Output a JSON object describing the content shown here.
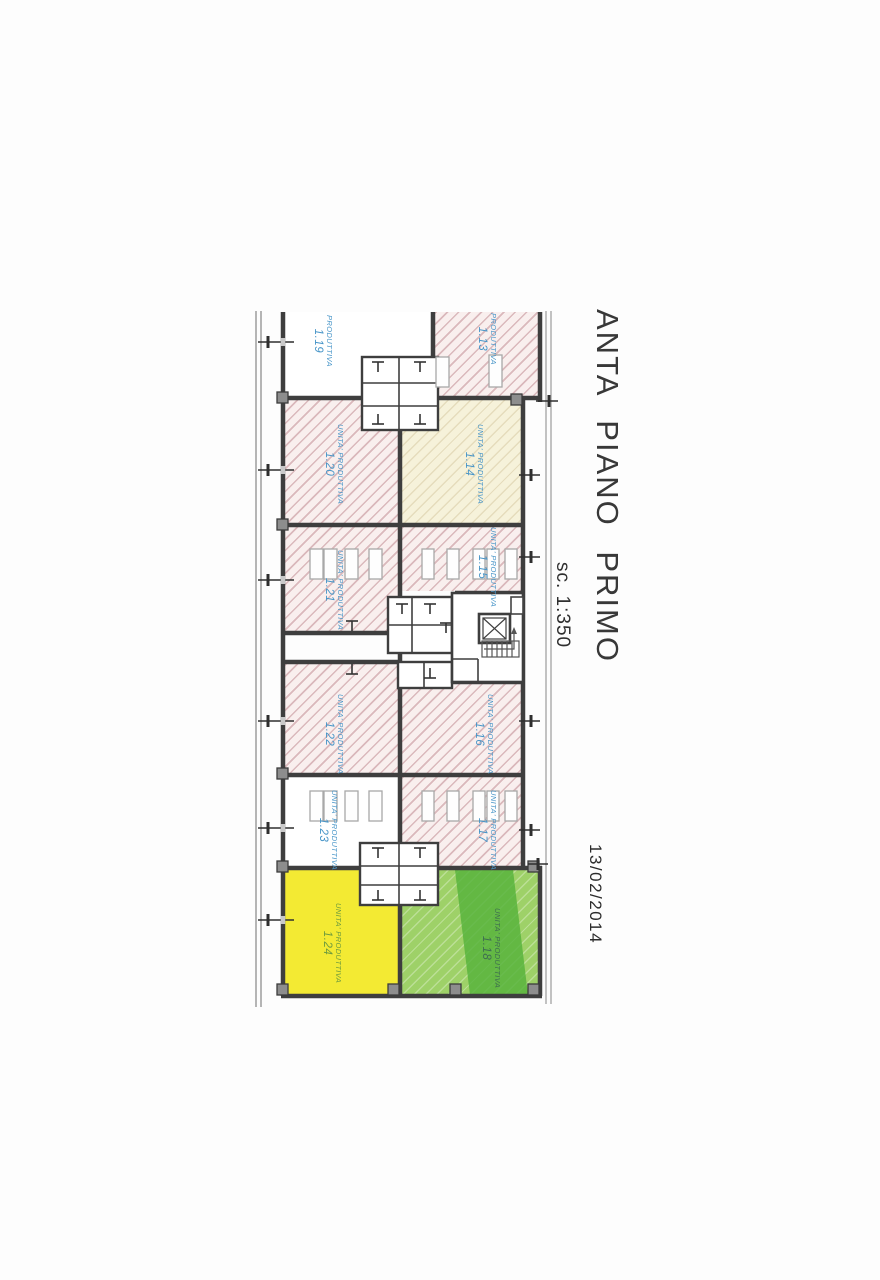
{
  "drawing": {
    "title": "ANTA PIANO PRIMO",
    "scale": "sc. 1:350",
    "date": "13/02/2014"
  },
  "rooms": [
    {
      "label": "PRODUTTIVA",
      "number": "1.19",
      "fill": "white"
    },
    {
      "label": "PRODUTTIVA",
      "number": "1.13",
      "fill": "pink-hatch"
    },
    {
      "label": "UNITA' PRODUTTIVA",
      "number": "1.20",
      "fill": "pink-hatch"
    },
    {
      "label": "UNITA' PRODUTTIVA",
      "number": "1.14",
      "fill": "cream-hatch"
    },
    {
      "label": "UNITA' PRODUTTIVA",
      "number": "1.21",
      "fill": "pink-hatch"
    },
    {
      "label": "UNITA' PRODUTTIVA",
      "number": "1.15",
      "fill": "pink-hatch"
    },
    {
      "label": "UNITA' PRODUTTIVA",
      "number": "1.22",
      "fill": "pink-hatch"
    },
    {
      "label": "UNITA' PRODUTTIVA",
      "number": "1.16",
      "fill": "pink-hatch"
    },
    {
      "label": "UNITA' PRODUTTIVA",
      "number": "1.23",
      "fill": "white"
    },
    {
      "label": "UNITA' PRODUTTIVA",
      "number": "1.17",
      "fill": "pink-hatch"
    },
    {
      "label": "UNITA' PRODUTTIVA",
      "number": "1.24",
      "fill": "yellow"
    },
    {
      "label": "UNITA' PRODUTTIVA",
      "number": "1.18",
      "fill": "green-hatch"
    }
  ],
  "colors": {
    "wall": "#3e3e3e",
    "hatch_pink_bg": "#f9efee",
    "hatch_pink_line": "#c18c92",
    "cream_bg": "#f6f2da",
    "yellow": "#f3ea33",
    "green_bg": "#9ed168",
    "green_band": "#54b13a",
    "label_blue": "#4795c8",
    "boundary_gray": "#b5b5b5"
  }
}
